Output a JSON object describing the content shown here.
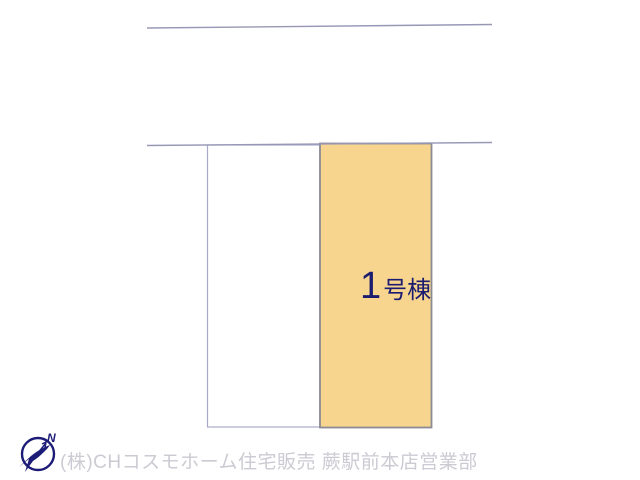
{
  "site_plan": {
    "plots": [
      {
        "id": "empty-plot",
        "label": "",
        "fill": "#FFFFFF"
      },
      {
        "id": "building-1",
        "label": "1号棟",
        "label_number": "1",
        "label_suffix": "号棟",
        "fill": "#F7D58F"
      }
    ],
    "colors": {
      "road_line": "#9898B6",
      "empty_plot_border": "#A9A9CB",
      "building_plot_border": "#8B8B94",
      "building_label": "#1B1B70"
    }
  },
  "compass": {
    "north_label": "N",
    "color": "#1C1C78"
  },
  "footer": {
    "company_line": "(株)CHコスモホーム住宅販売 蕨駅前本店営業部",
    "color": "#CBCBD3"
  }
}
